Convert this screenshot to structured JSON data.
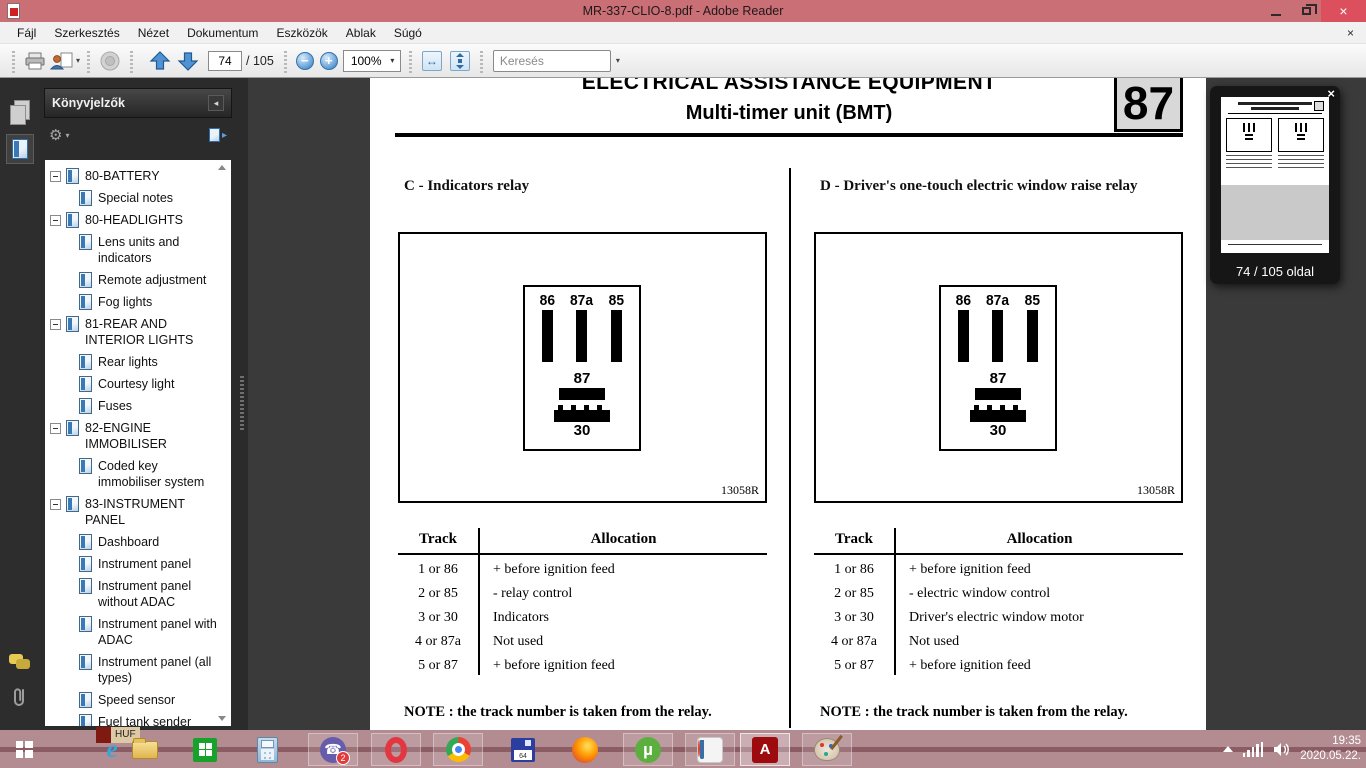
{
  "window": {
    "title": "MR-337-CLIO-8.pdf - Adobe Reader"
  },
  "menu": {
    "items": [
      "Fájl",
      "Szerkesztés",
      "Nézet",
      "Dokumentum",
      "Eszközök",
      "Ablak",
      "Súgó"
    ]
  },
  "toolbar": {
    "page_current": "74",
    "page_total": "/ 105",
    "zoom_level": "100%",
    "search_placeholder": "Keresés"
  },
  "icons": {
    "close_x": "×",
    "gear": "⚙",
    "caret_down": "▾",
    "caret_left": "◂",
    "caret_right": "▸",
    "zoom_out": "−",
    "zoom_in": "+",
    "fit_width": "↔",
    "ie_e": "e",
    "utorrent_mu": "µ",
    "adobe_a": "A",
    "viber_phone": "☎"
  },
  "bookmarks": {
    "panel_title": "Könyvjelzők",
    "items": [
      {
        "label": "80-BATTERY",
        "level": 0
      },
      {
        "label": "Special notes",
        "level": 1
      },
      {
        "label": "80-HEADLIGHTS",
        "level": 0
      },
      {
        "label": "Lens units and indicators",
        "level": 1
      },
      {
        "label": "Remote adjustment",
        "level": 1
      },
      {
        "label": "Fog lights",
        "level": 1
      },
      {
        "label": "81-REAR AND INTERIOR LIGHTS",
        "level": 0
      },
      {
        "label": "Rear lights",
        "level": 1
      },
      {
        "label": "Courtesy light",
        "level": 1
      },
      {
        "label": "Fuses",
        "level": 1
      },
      {
        "label": "82-ENGINE IMMOBILISER",
        "level": 0
      },
      {
        "label": "Coded key immobiliser system",
        "level": 1
      },
      {
        "label": "83-INSTRUMENT PANEL",
        "level": 0
      },
      {
        "label": "Dashboard",
        "level": 1
      },
      {
        "label": "Instrument panel",
        "level": 1
      },
      {
        "label": "Instrument panel without ADAC",
        "level": 1
      },
      {
        "label": "Instrument panel with ADAC",
        "level": 1
      },
      {
        "label": "Instrument panel (all types)",
        "level": 1
      },
      {
        "label": "Speed sensor",
        "level": 1
      },
      {
        "label": "Fuel tank sender",
        "level": 1
      }
    ]
  },
  "document": {
    "header": {
      "line1": "ELECTRICAL ASSISTANCE EQUIPMENT",
      "line2": "Multi-timer unit (BMT)",
      "chapter": "87"
    },
    "relay": {
      "top_pins": [
        "86",
        "87a",
        "85"
      ],
      "mid_pin": "87",
      "bottom_pin": "30"
    },
    "sections": [
      {
        "heading": "C - Indicators relay",
        "figure_ref": "13058R",
        "table": {
          "col_track": "Track",
          "col_allocation": "Allocation",
          "rows": [
            {
              "track": "1 or 86",
              "allocation": "+ before ignition feed"
            },
            {
              "track": "2 or 85",
              "allocation": "- relay control"
            },
            {
              "track": "3 or 30",
              "allocation": "Indicators"
            },
            {
              "track": "4 or 87a",
              "allocation": "Not used"
            },
            {
              "track": "5 or 87",
              "allocation": "+ before ignition feed"
            }
          ]
        },
        "note": "NOTE : the track number is taken from the relay."
      },
      {
        "heading": "D - Driver's one-touch electric window raise relay",
        "figure_ref": "13058R",
        "table": {
          "col_track": "Track",
          "col_allocation": "Allocation",
          "rows": [
            {
              "track": "1 or 86",
              "allocation": "+ before ignition feed"
            },
            {
              "track": "2 or 85",
              "allocation": "- electric window control"
            },
            {
              "track": "3 or 30",
              "allocation": "Driver's electric window motor"
            },
            {
              "track": "4 or 87a",
              "allocation": "Not used"
            },
            {
              "track": "5 or 87",
              "allocation": "+ before ignition feed"
            }
          ]
        },
        "note": "NOTE : the track number is taken from the relay."
      }
    ]
  },
  "popup": {
    "page_label": "74 / 105 oldal"
  },
  "taskbar": {
    "huf_label": "HUF",
    "viber_badge": "2",
    "floppy_label": "64",
    "tray": {
      "time": "19:35",
      "date": "2020.05.22."
    }
  },
  "colors": {
    "titlebar": "#c96f75",
    "close_button": "#dc505e",
    "taskbar": "#b38c92",
    "document_background": "#3a3a3a",
    "panel_background": "#2b2b2b",
    "accent_blue": "#3b82c4",
    "adobe_red": "#9e0b0f"
  }
}
